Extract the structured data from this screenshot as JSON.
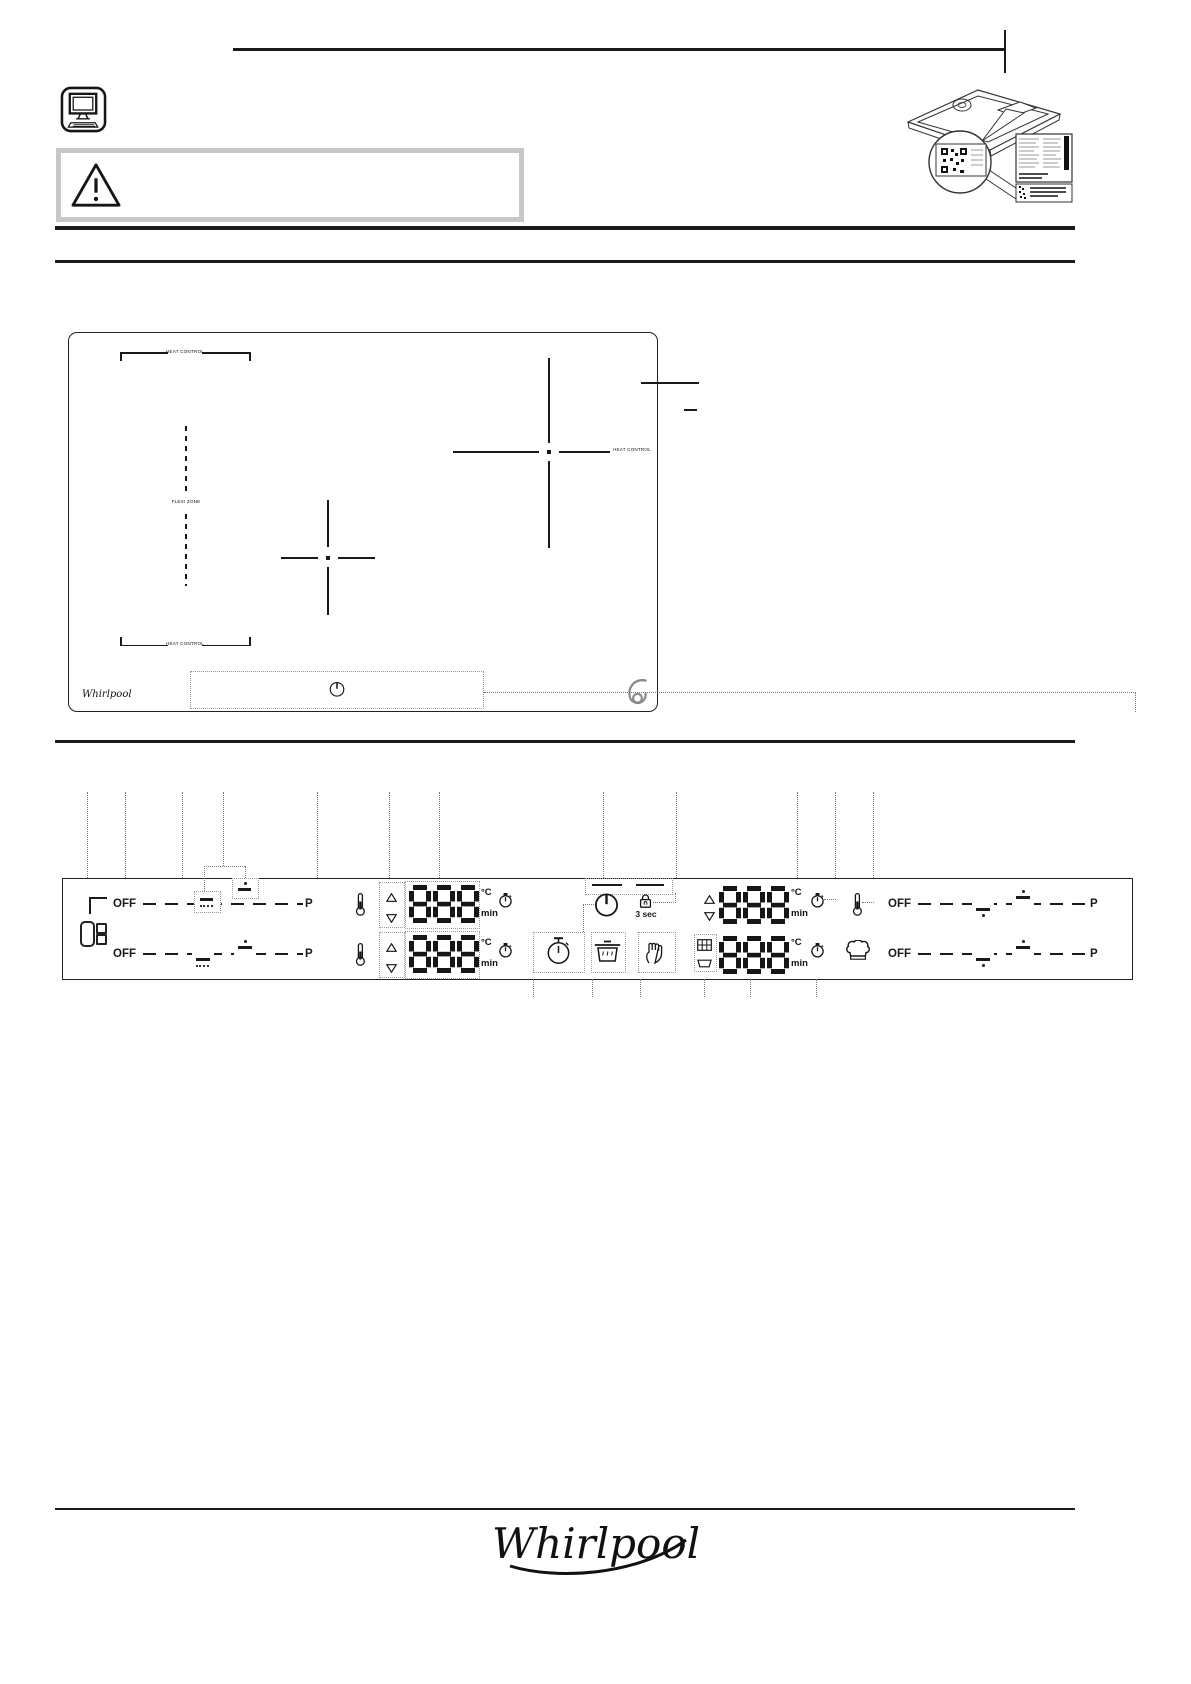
{
  "labels": {
    "off": "OFF",
    "boost": "P",
    "hold": "3 sec",
    "celsius": "°C",
    "minutes": "min",
    "display": "888"
  },
  "hob": {
    "heat_control": "HEAT CONTROL",
    "flexi_zone": "FLEXI ZONE",
    "brand": "Whirlpool",
    "sense_mark": "6"
  },
  "footer": {
    "brand": "Whirlpool"
  },
  "icons": {
    "online-manual-icon": "🖥",
    "warning-icon": "⚠",
    "thermometer-icon": "🌡",
    "timer-icon": "⏲",
    "power-icon": "⏻",
    "lock-icon": "🔒",
    "arrow-up-icon": "△",
    "arrow-down-icon": "▽",
    "chef-hat-icon": "👨‍🍳",
    "stopwatch-icon": "⏱",
    "pot-icon": "🍲",
    "hand-icon": "✋",
    "grill-icon": "▦",
    "dish-icon": "▭",
    "flexi-zone-icon": "▯::",
    "qr-code-icon": "▩",
    "sixth-sense-icon": "6"
  }
}
